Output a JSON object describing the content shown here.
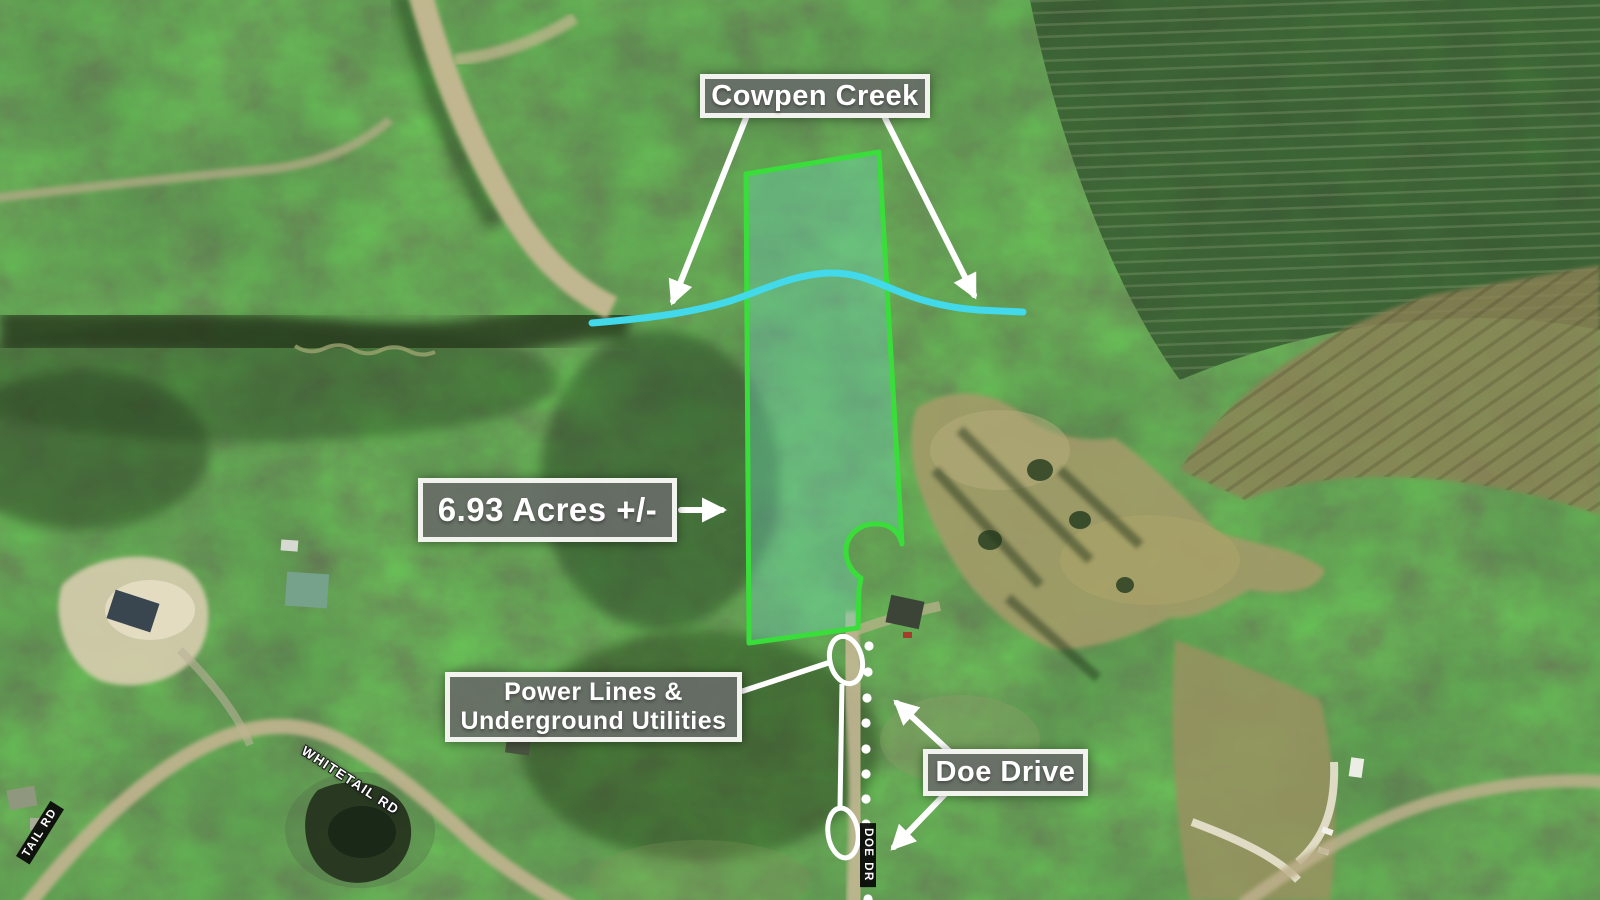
{
  "map": {
    "annotations": {
      "creek_label": "Cowpen Creek",
      "acreage_label": "6.93 Acres +/-",
      "utilities_label_line1": "Power Lines &",
      "utilities_label_line2": "Underground Utilities",
      "road_label": "Doe Drive"
    },
    "street_names": {
      "whitetail_rd": "WHITETAIL RD",
      "whitetail_rd_edge": "TAIL RD",
      "doe_dr": "DOE DR"
    },
    "colors": {
      "parcel_outline": "#3ade3a",
      "parcel_fill": "rgba(110,210,180,0.40)",
      "creek_line": "#42d9ea",
      "annotation_white": "#ffffff",
      "label_box_bg": "rgba(104,108,104,0.92)",
      "label_box_border": "#f2f2ee"
    }
  }
}
